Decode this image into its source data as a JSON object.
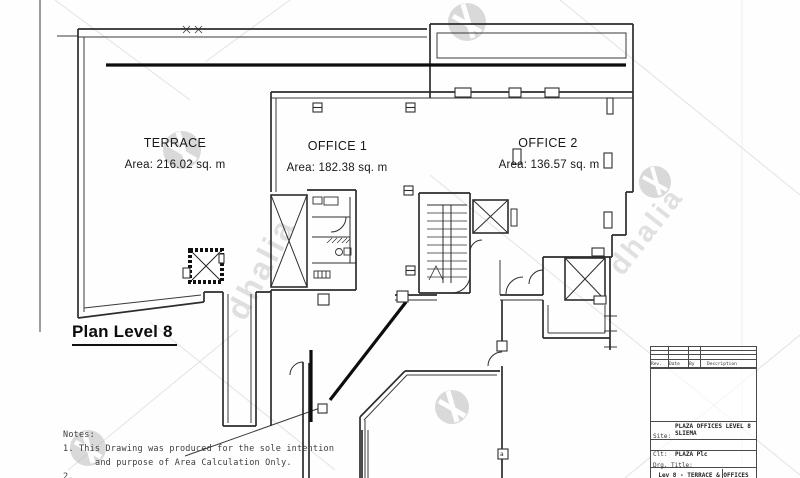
{
  "plan": {
    "title": "Plan Level 8",
    "rooms": [
      {
        "name": "TERRACE",
        "area": "Area: 216.02 sq. m"
      },
      {
        "name": "OFFICE 1",
        "area": "Area: 182.38 sq. m"
      },
      {
        "name": "OFFICE 2",
        "area": "Area: 136.57 sq. m"
      }
    ],
    "door_label": "a"
  },
  "notes": {
    "heading": "Notes:",
    "line1": "1.  This Drawing was produced for the sole intention",
    "line2": "and purpose of Area Calculation Only.",
    "line3": "2."
  },
  "title_block": {
    "rev_header": {
      "rev": "Rev.",
      "date": "Date",
      "by": "By",
      "description": "Description"
    },
    "site_label": "Site:",
    "site_value_1": "PLAZA OFFICES LEVEL 8",
    "site_value_2": "SLIEMA",
    "client_label": "Clt:",
    "client_value": "PLAZA Plc",
    "drg_title_label": "Drg. Title:",
    "drg_title_value": "Lev 8 - TERRACE & OFFICES",
    "drg_no_label": "Drg. No."
  },
  "watermark": {
    "text": "dhalia"
  }
}
